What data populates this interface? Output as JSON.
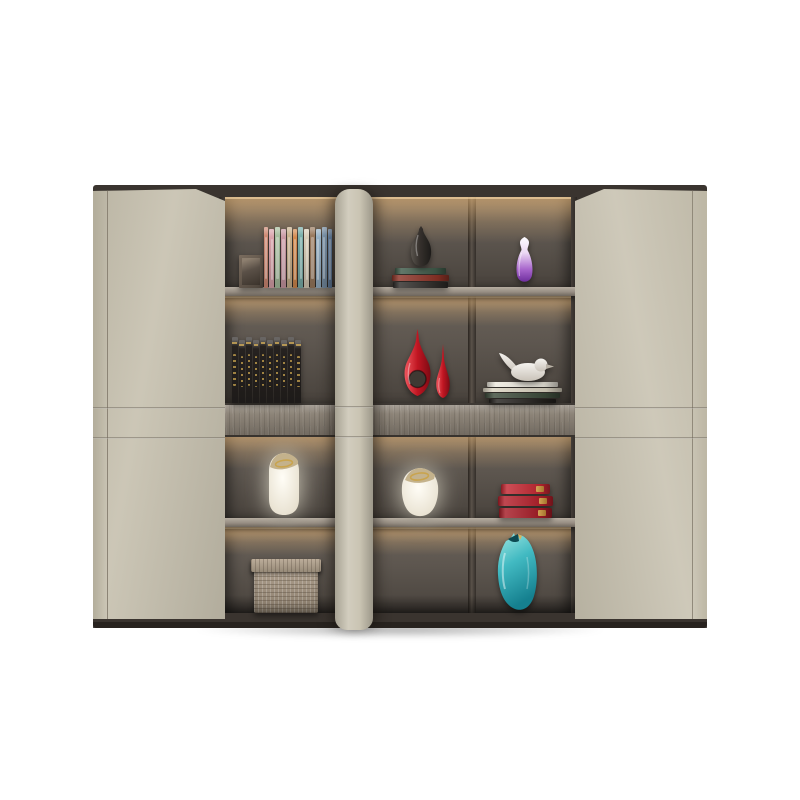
{
  "scene": {
    "type": "product-photo",
    "subject": "modern two-door office filing cabinet with lit open shelving",
    "background": "#ffffff"
  },
  "palette": {
    "background": "#ffffff",
    "door": "#c6c0ae",
    "stile": "#c8c2b0",
    "carcass_dark": "#3a342f",
    "interior_back": "#5d564f",
    "shelf": "#978e83",
    "shelf_edge": "#b6ada1",
    "drawer_wood": "#8d8478",
    "base": "#241f1b",
    "glow_warm": "#ffc87c"
  },
  "cabinet": {
    "left_door_label": "closed hinged door (left)",
    "right_door_label": "closed hinged door (right)",
    "stile_label": "center vertical panel",
    "drawer_label": "wood-grain drawer band",
    "shelf_contents": {
      "row1": {
        "left": "set of colorful hardcover books with small dark frame",
        "middle": "dark glass vase on magazine stack",
        "right": "white-to-purple gradient vase"
      },
      "row2": {
        "left": "black encyclopedia set with gold lettering",
        "middle": "two glossy red teardrop vases",
        "right": "white bird figurine on book stack"
      },
      "row3": {
        "left": "tall white ceramic vase with gold rim",
        "middle": "round white ceramic vase with gold rim",
        "right": "stack of three red books with gold trim"
      },
      "row4": {
        "left": "woven basket box with lid",
        "middle": "empty compartment",
        "right": "teal art-glass vase"
      }
    }
  },
  "items": {
    "colorful_books": {
      "label": "colorful book set",
      "count": 12,
      "colors": [
        "#cf8a74",
        "#d9a3ab",
        "#a8bf9f",
        "#c998a3",
        "#c9b28e",
        "#d28a4e",
        "#7aafaa",
        "#d8cdb8",
        "#9a7a5e",
        "#9ab4c8",
        "#8099b0",
        "#6f8fb5"
      ]
    },
    "picture_frame": {
      "label": "small dark frame",
      "color": "#5e5248"
    },
    "magazine_stack": {
      "label": "magazine stack",
      "colors": [
        "#3f5a49",
        "#8a3226",
        "#2e2b28"
      ]
    },
    "dark_vase": {
      "label": "dark glass vase",
      "light": "#5a544e",
      "color": "#35302c",
      "dark": "#1d1b19"
    },
    "purple_vase": {
      "label": "purple gradient vase",
      "top": "#fdfcff",
      "upper": "#ecd9f4",
      "lower": "#a866cc",
      "bottom": "#6f2f9e"
    },
    "black_books": {
      "label": "black encyclopedia set",
      "count": 10,
      "colors": [
        "#262220",
        "#262220",
        "#262220",
        "#262220",
        "#262220",
        "#262220",
        "#262220",
        "#262220",
        "#262220",
        "#262220"
      ]
    },
    "red_vases": {
      "label": "red teardrop vases",
      "light": "#f0565e",
      "color": "#c01622",
      "dark": "#7e0a14",
      "hole": "#3f3933"
    },
    "bird_figurine": {
      "label": "white bird figurine",
      "color": "#f5f3ef",
      "shade": "#c9c2b8"
    },
    "bird_book_stack": {
      "label": "books under bird",
      "colors": [
        "#ece8dd",
        "#d9d2c0",
        "#3c4a3a",
        "#24211e"
      ]
    },
    "white_vase_tall": {
      "label": "tall white vase",
      "color": "#fffdf6",
      "shade": "#e2dac7",
      "opening": "#c4b28c",
      "gold": "#c9a44e"
    },
    "white_vase_round": {
      "label": "round white vase",
      "color": "#fffdf6",
      "shade": "#e2dac7",
      "opening": "#c4b28c",
      "gold": "#c9a44e"
    },
    "red_books": {
      "label": "red book stack",
      "count": 3,
      "colors": [
        "#c22731",
        "#b21f2a",
        "#a51b26"
      ],
      "gold": "#d8b25a"
    },
    "basket_box": {
      "label": "woven basket box",
      "color": "#a89a88"
    },
    "teal_vase": {
      "label": "teal art vase",
      "top": "#9fe7e2",
      "mid": "#42bac2",
      "bottom": "#15808f",
      "dark": "#0c4a52",
      "gold": "#d8b25a"
    }
  }
}
